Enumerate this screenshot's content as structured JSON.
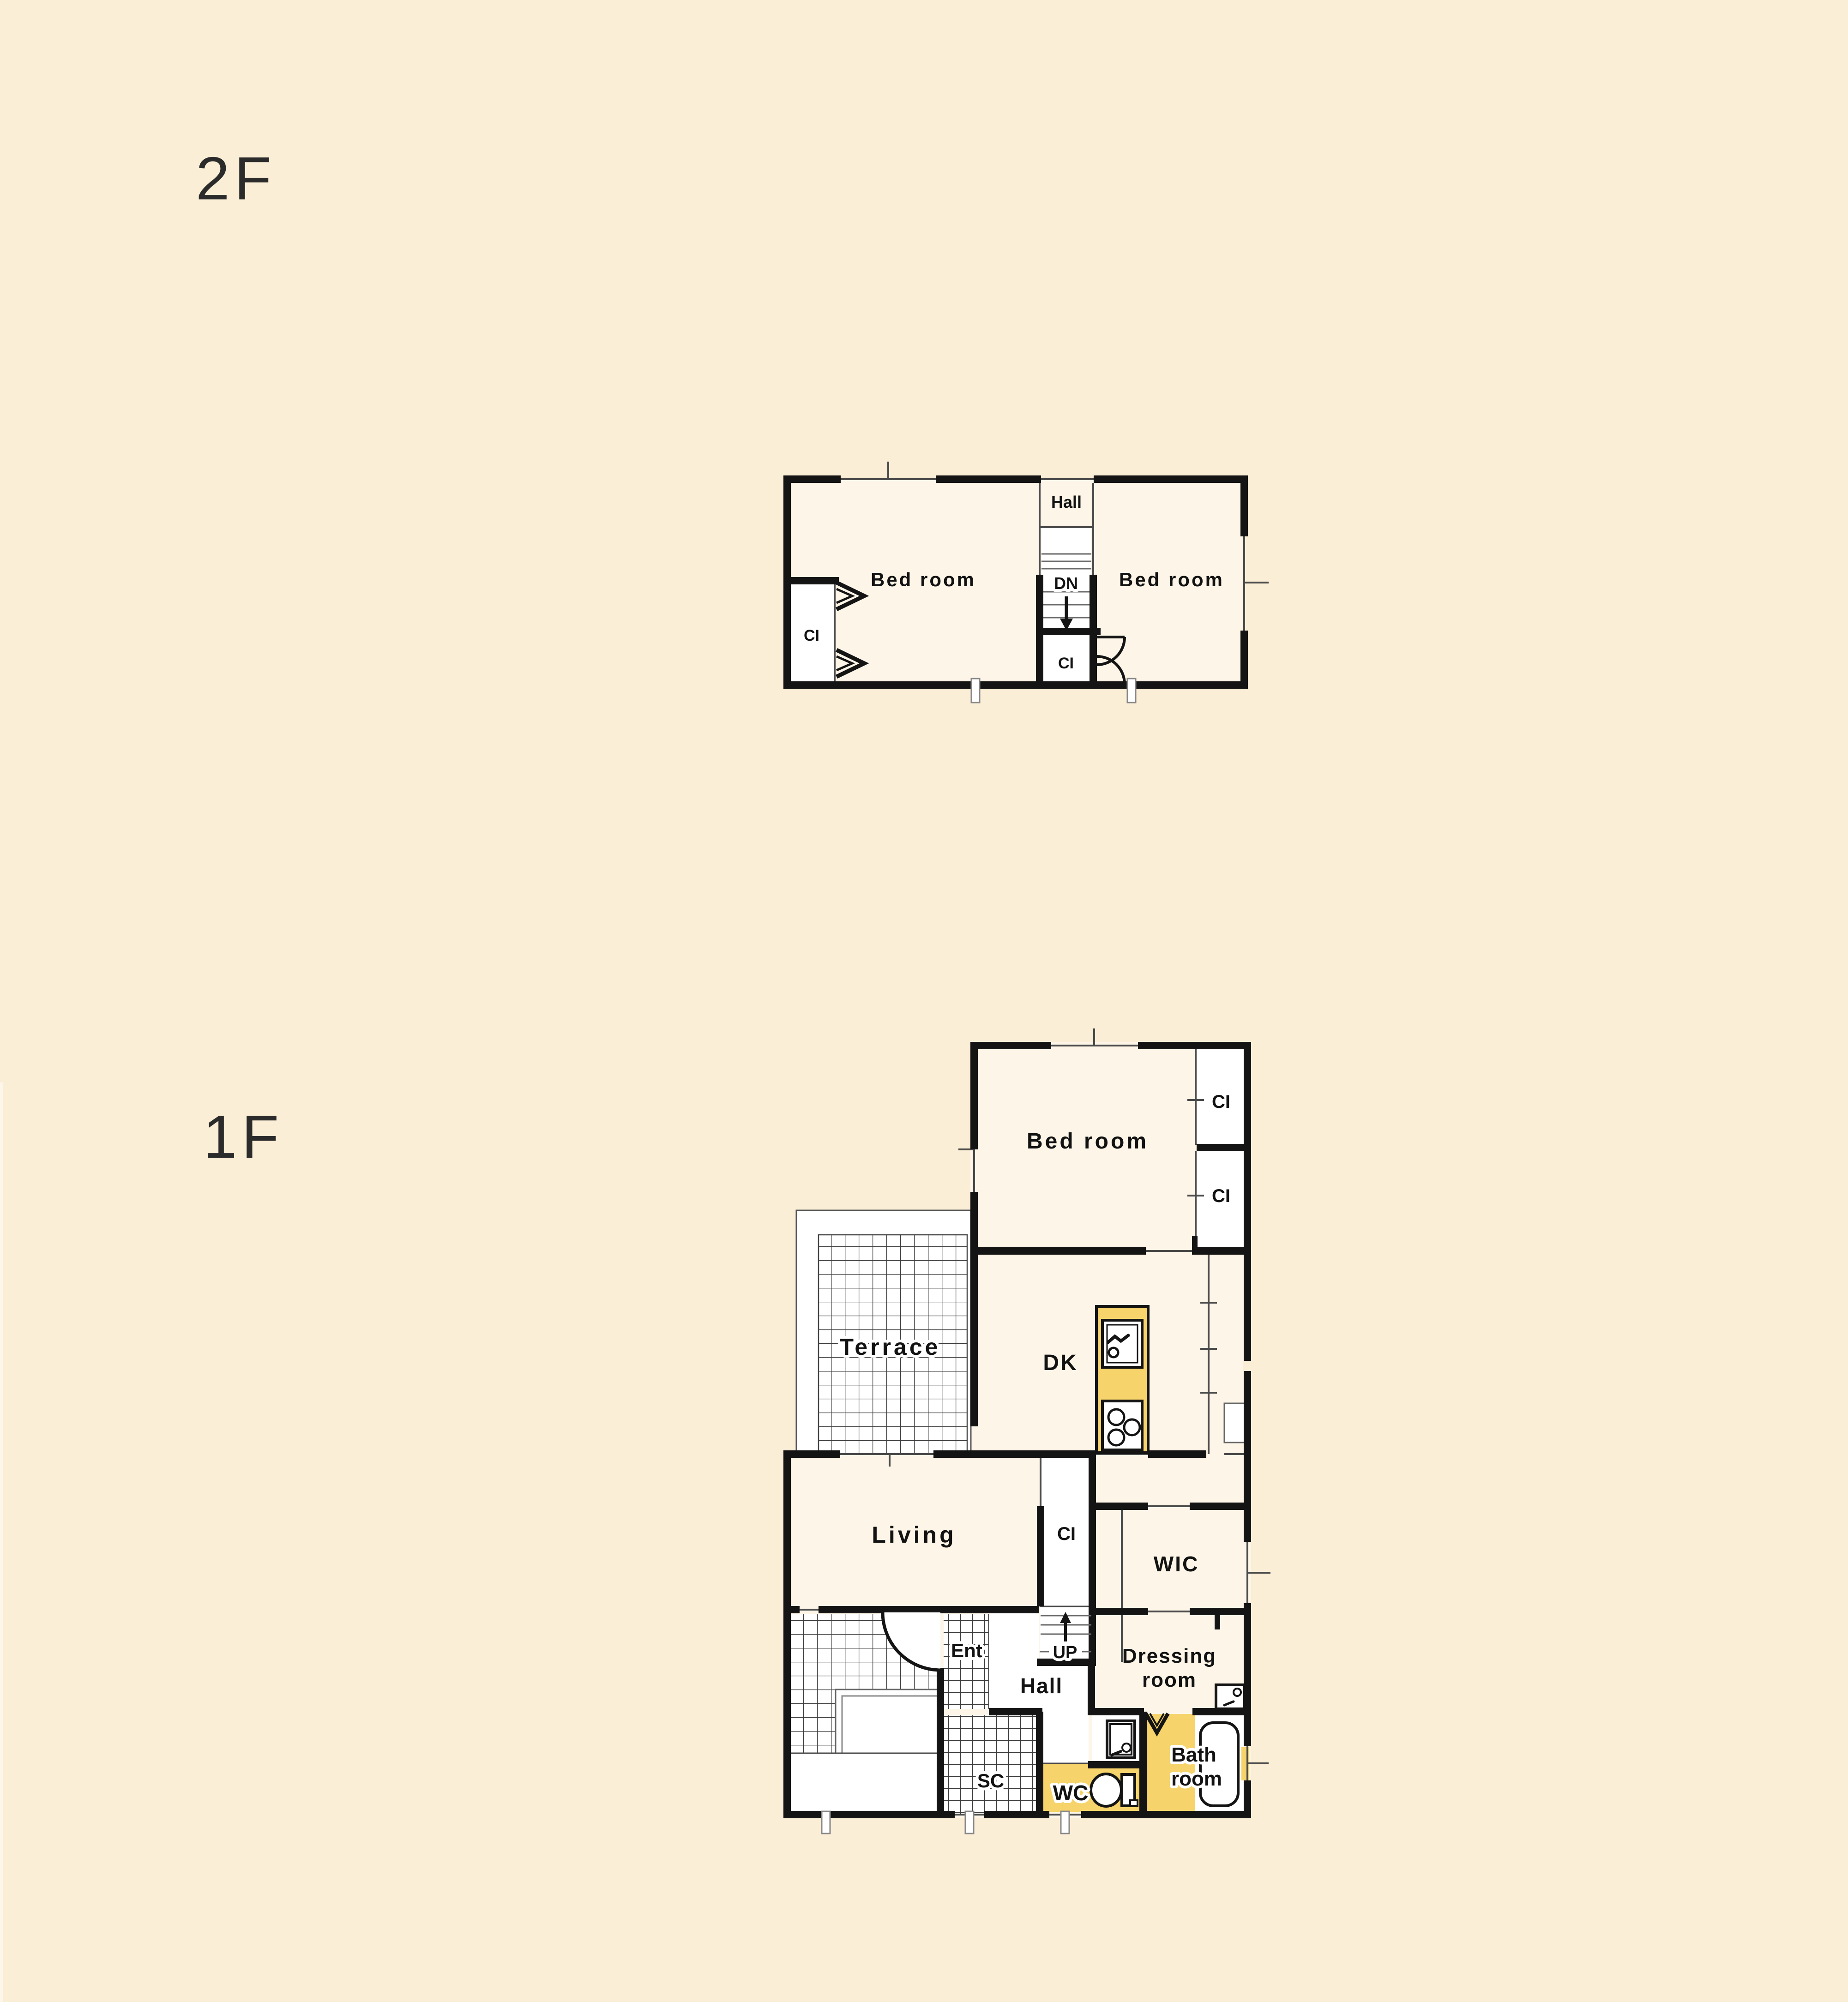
{
  "page": {
    "background_color": "#FBEED6",
    "room_fill_color": "#FDF6E8",
    "wet_area_color": "#F6D46B",
    "wall_color": "#141414",
    "tile_color": "#FFFFFF"
  },
  "floors": [
    {
      "id": "2f",
      "label": "2F",
      "rooms": {
        "hall": "Hall",
        "bedroom_left": "Bed room",
        "bedroom_right": "Bed room",
        "stairs_down": "DN",
        "closet_left": "CI",
        "closet_stair": "CI"
      }
    },
    {
      "id": "1f",
      "label": "1F",
      "rooms": {
        "bedroom": "Bed room",
        "closet_a": "CI",
        "closet_b": "CI",
        "terrace": "Terrace",
        "dining_kitchen": "DK",
        "living": "Living",
        "closet_hall": "CI",
        "walk_in_closet": "WIC",
        "entrance": "Ent",
        "hall": "Hall",
        "stairs_up": "UP",
        "dressing_line1": "Dressing",
        "dressing_line2": "room",
        "shoe_closet": "SC",
        "toilet": "WC",
        "bath_line1": "Bath",
        "bath_line2": "room"
      }
    }
  ]
}
